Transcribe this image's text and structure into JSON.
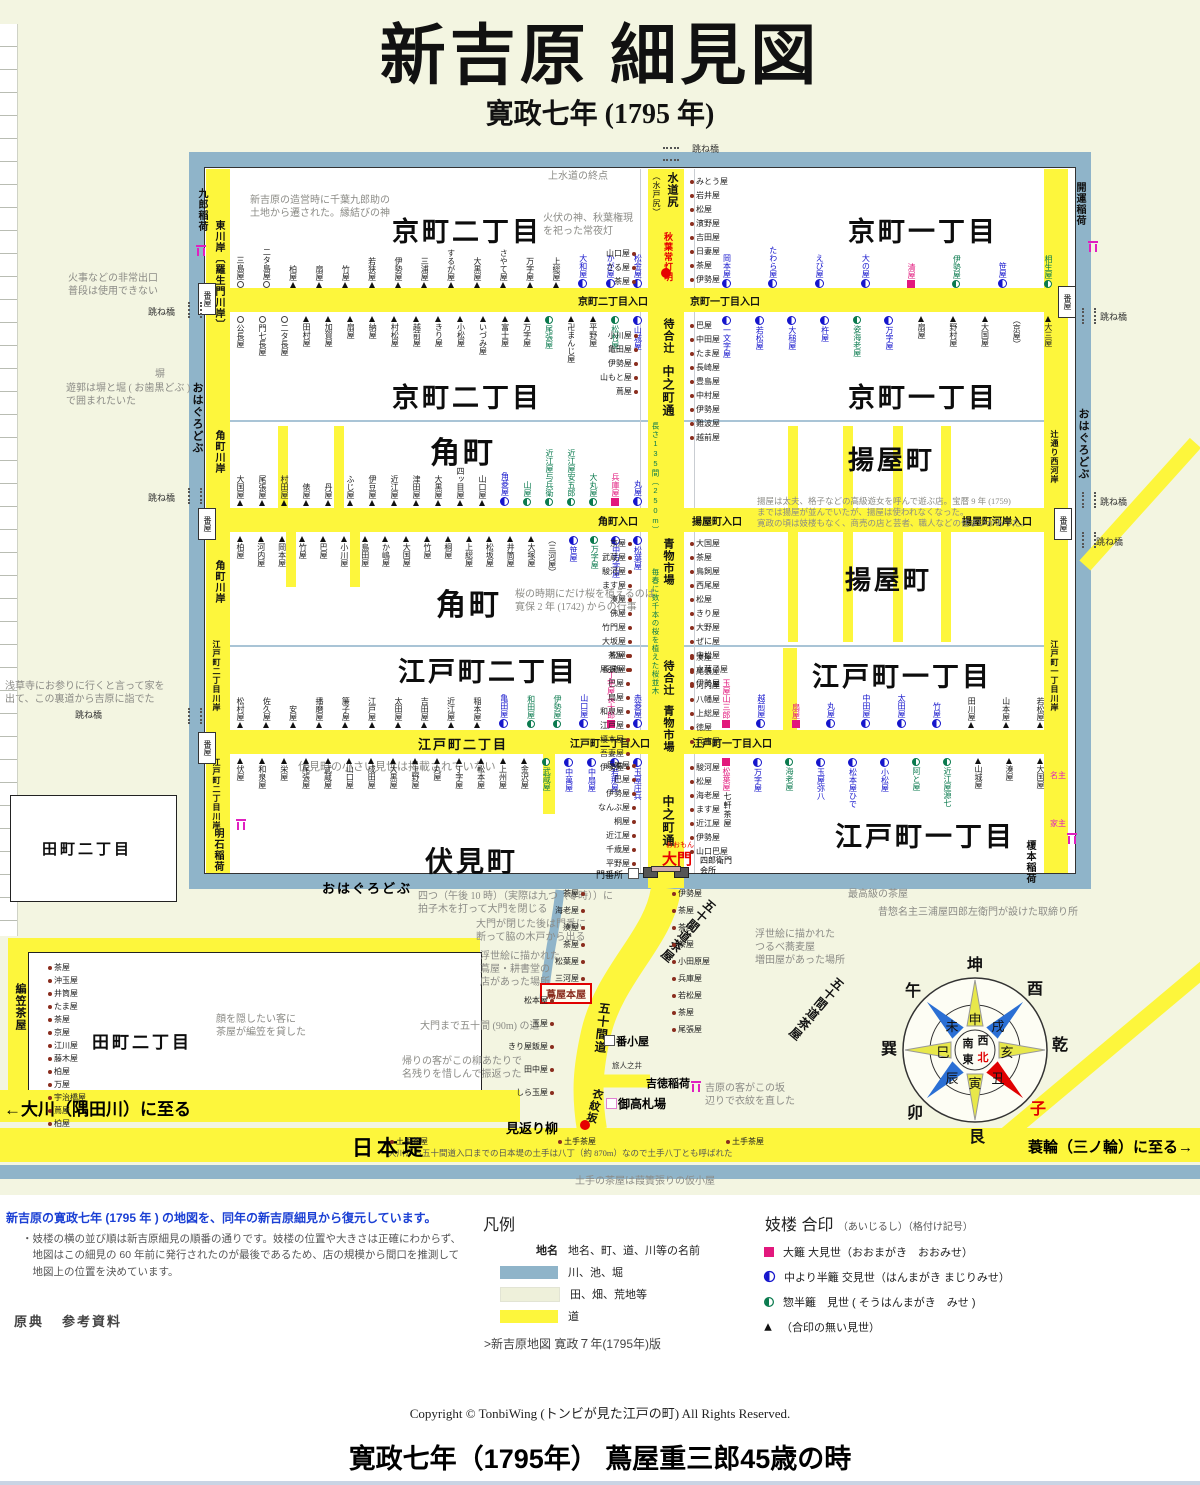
{
  "title": "新吉原 細見図",
  "subtitle": "寛政七年 (1795 年)",
  "map": {
    "districts": {
      "kyo2": "京町二丁目",
      "kyo1": "京町一丁目",
      "sumicho": "角町",
      "ageya": "揚屋町",
      "edo2": "江戸町二丁目",
      "edo1": "江戸町一丁目",
      "fushimi": "伏見町",
      "tamachi2": "田町二丁目"
    },
    "entrances": {
      "kyo2": "京町二丁目入口",
      "kyo1": "京町一丁目入口",
      "sumicho": "角町入口",
      "ageya": "揚屋町入口",
      "ageyakashi": "揚屋町河岸入口",
      "edo2": "江戸町二丁目入口",
      "edo1": "江戸町一丁目入口"
    },
    "streets": {
      "higashikawagishi": "東川岸〔羅生門川岸〕",
      "sumichokawagishi": "角町川岸",
      "edo2kawagishi": "江戸町二丁目川岸",
      "edo1kawagishi": "江戸町一丁目川岸",
      "tsujidori": "辻通り西河岸",
      "ohaguro": "おはぐろどぶ",
      "nakanocho": "中之町通",
      "machiaitsuji": "待合辻",
      "aomono": "青物市場",
      "nagasa": "長さ135間（250m）",
      "sakura": "毎春に数千本の桜を植えた桜並木",
      "mizudojiri": "水道尻",
      "mitojiri": "（水戸尻）",
      "gojikkendo": "五十間道",
      "gojikkenchaya": "五十間道茶屋",
      "emonzaka": "衣紋坂",
      "nihondutsumi": "日本堤",
      "okawa": "←大川（隅田川）に至る",
      "minowa": "蓑輪（三ノ輪）に至る→",
      "amigasa": "編笠茶屋",
      "edo2onroad": "江戸町二丁目"
    },
    "shrines": {
      "kuro": "九郎稲荷",
      "kaiun": "開運稲荷",
      "akashi": "明石稲荷",
      "enomoto": "榎本稲荷",
      "yoshitoku": "吉徳稲荷"
    },
    "features": {
      "akiba": "秋葉常灯明",
      "omon": "大門",
      "omonkana": "おおもん",
      "monbansho": "門番所",
      "kaisho": "四郎衛門会所",
      "shichiken": "七軒茶屋",
      "tsutaya": "蔦屋本屋",
      "mikaeri": "見返り柳",
      "kosatsuba": "御高札場",
      "bangoya": "番小屋",
      "tabibito": "旅人之井",
      "banya": "番屋",
      "hanebashi": "跳ね橋",
      "hei": "塀",
      "dotechaya": "土手茶屋",
      "nushi": "名主",
      "yanushi": "家主"
    },
    "annotations": {
      "a1": "新吉原の造営時に千葉九郎助の\n土地から遷された。縁結びの神",
      "a2": "火伏の神、秋葉権現\nを祀った常夜灯",
      "a3": "上水道の終点",
      "a4": "火事などの非常出口\n普段は使用できない",
      "a6": "遊郭は塀と堀 ( お歯黒どぶ )\nで囲まれたいた",
      "a7": "浅草寺にお参りに行くと言って家を\n出て、この裏道から吉原に詣でた",
      "a8": "揚屋は太夫、格子などの高級遊女を呼んで遊ぶ店。宝暦 9 年 (1759)\nまでは揚屋が並んでいたが、揚屋は使われなくなった。\n寛政の頃は妓楼もなく、商売の店と芸者、職人などの住まいがあった。",
      "a9": "桜の時期にだけ桜を植えるのは\n寛保 2 年 (1742) からの行事",
      "a10": "伏見町の小さい見世は掲載されていない",
      "a11": "四つ（午後 10 時）（実際は九つ（零時））に\n拍子木を打って大門を閉じる",
      "a12": "大門が閉じた後は門番に\n断って脇の木戸から出る",
      "a13": "浮世絵に描かれた\n蔦屋・耕書堂の\n店があった場所",
      "a14": "大門まで五十間 (90m) の道",
      "a15": "最高級の茶屋",
      "a16": "昔惣名主三浦屋四郎左衛門が設けた取締り所",
      "a17": "浮世絵に描かれた\nつるべ蕎麦屋\n増田屋があった場所",
      "a18": "吉原の客がこの坂\n辺りで衣紋を直した",
      "a19": "帰りの客がこの柳あたりで\n名残りを惜しんで振返った",
      "a20": "大川から五十間道入口までの日本堤の土手は八丁（約 870m）なので土手八丁とも呼ばれた",
      "a21": "土手の茶屋は葭簀張りの仮小屋",
      "a22": "顔を隠したい客に\n茶屋が編笠を貸した"
    },
    "rows": {
      "kyo2n": [
        {
          "n": "三島屋",
          "m": "o"
        },
        {
          "n": "二タ島屋",
          "m": "o"
        },
        {
          "n": "柏屋",
          "m": "t"
        },
        {
          "n": "扇屋",
          "m": "t"
        },
        {
          "n": "竹屋",
          "m": "t"
        },
        {
          "n": "若狭屋",
          "m": "t"
        },
        {
          "n": "伊勢屋",
          "m": "t"
        },
        {
          "n": "三浦屋",
          "m": "t"
        },
        {
          "n": "するが屋",
          "m": "t"
        },
        {
          "n": "大黒屋",
          "m": "t"
        },
        {
          "n": "さやて屋",
          "m": "t"
        },
        {
          "n": "万字屋",
          "m": "t"
        },
        {
          "n": "上総屋",
          "m": "t"
        },
        {
          "n": "大和屋",
          "m": "b"
        },
        {
          "n": "かが屋",
          "m": "b"
        },
        {
          "n": "松金屋",
          "m": "b"
        }
      ],
      "kyo2s": [
        {
          "n": "公長屋",
          "m": "o"
        },
        {
          "n": "門七長屋",
          "m": "o"
        },
        {
          "n": "二タ長屋",
          "m": "o"
        },
        {
          "n": "田村屋",
          "m": "t"
        },
        {
          "n": "加賀屋",
          "m": "t"
        },
        {
          "n": "扇屋",
          "m": "t"
        },
        {
          "n": "納屋",
          "m": "t"
        },
        {
          "n": "村松屋",
          "m": "t"
        },
        {
          "n": "越前屋",
          "m": "t"
        },
        {
          "n": "きり屋",
          "m": "t"
        },
        {
          "n": "小松屋",
          "m": "t"
        },
        {
          "n": "いづみ屋",
          "m": "t"
        },
        {
          "n": "富士屋",
          "m": "t"
        },
        {
          "n": "万字屋",
          "m": "t"
        },
        {
          "n": "尾張屋",
          "m": "g"
        },
        {
          "n": "卍まんじ屋",
          "m": "t"
        },
        {
          "n": "平野屋",
          "m": "t"
        },
        {
          "n": "松村屋",
          "m": "g"
        },
        {
          "n": "山城屋",
          "m": "b"
        }
      ],
      "kyo1n": [
        {
          "n": "岡本屋",
          "m": "b"
        },
        {
          "n": "たわら屋",
          "m": "b"
        },
        {
          "n": "えび屋",
          "m": "b"
        },
        {
          "n": "大の屋",
          "m": "b"
        },
        {
          "n": "清屋",
          "m": "m"
        },
        {
          "n": "伊勢屋",
          "m": "g"
        },
        {
          "n": "笹屋",
          "m": "b"
        },
        {
          "n": "相生屋",
          "m": "g"
        }
      ],
      "kyo1s": [
        {
          "n": "一文字屋",
          "m": "b"
        },
        {
          "n": "若松屋",
          "m": "b"
        },
        {
          "n": "大槌屋",
          "m": "b"
        },
        {
          "n": "杵屋",
          "m": "b"
        },
        {
          "n": "姿海老屋",
          "m": "g"
        },
        {
          "n": "万字屋",
          "m": "b"
        },
        {
          "n": "扇屋",
          "m": "t"
        },
        {
          "n": "野村屋",
          "m": "t"
        },
        {
          "n": "大国屋",
          "m": "t"
        },
        {
          "n": "（京屋）",
          "m": "none"
        },
        {
          "n": "大三屋",
          "m": "t"
        }
      ],
      "sumin": [
        {
          "n": "大国屋",
          "m": "t"
        },
        {
          "n": "尾張屋",
          "m": "t"
        },
        {
          "n": "村田屋",
          "m": "t"
        },
        {
          "n": "俵屋",
          "m": "t"
        },
        {
          "n": "丹屋",
          "m": "t"
        },
        {
          "n": "ふじ屋",
          "m": "t"
        },
        {
          "n": "伊豆屋",
          "m": "t"
        },
        {
          "n": "近江屋",
          "m": "t"
        },
        {
          "n": "津田屋",
          "m": "t"
        },
        {
          "n": "大黒屋",
          "m": "t"
        },
        {
          "n": "四ッ目屋",
          "m": "t"
        },
        {
          "n": "山口屋",
          "m": "t"
        },
        {
          "n": "角菱屋",
          "m": "b"
        },
        {
          "n": "山屋",
          "m": "g"
        },
        {
          "n": "近江屋与兵衛",
          "m": "g"
        },
        {
          "n": "近江屋安五郎",
          "m": "g"
        },
        {
          "n": "大丸屋",
          "m": "g"
        },
        {
          "n": "兵庫屋",
          "m": "m"
        },
        {
          "n": "丸屋",
          "m": "b"
        }
      ],
      "sumis": [
        {
          "n": "柏屋",
          "m": "t"
        },
        {
          "n": "河内屋",
          "m": "t"
        },
        {
          "n": "岡本屋",
          "m": "t"
        },
        {
          "n": "竹屋",
          "m": "t"
        },
        {
          "n": "巴屋",
          "m": "t"
        },
        {
          "n": "小川屋",
          "m": "t"
        },
        {
          "n": "島田屋",
          "m": "t"
        },
        {
          "n": "か嶋屋",
          "m": "t"
        },
        {
          "n": "大国屋",
          "m": "t"
        },
        {
          "n": "竹屋",
          "m": "t"
        },
        {
          "n": "桐屋",
          "m": "t"
        },
        {
          "n": "上総屋",
          "m": "t"
        },
        {
          "n": "松坂屋",
          "m": "t"
        },
        {
          "n": "井筒屋",
          "m": "t"
        },
        {
          "n": "大塚屋",
          "m": "t"
        },
        {
          "n": "（三河屋）",
          "m": "none"
        },
        {
          "n": "笹屋",
          "m": "b"
        },
        {
          "n": "万字屋",
          "m": "g"
        },
        {
          "n": "中万字屋",
          "m": "b"
        },
        {
          "n": "松葉屋",
          "m": "b"
        }
      ],
      "edo2n": [
        {
          "n": "松村屋",
          "m": "t"
        },
        {
          "n": "佐久屋",
          "m": "t"
        },
        {
          "n": "安屋",
          "m": "t"
        },
        {
          "n": "播磨屋",
          "m": "t"
        },
        {
          "n": "簾子屋",
          "m": "t"
        },
        {
          "n": "江戸屋",
          "m": "t"
        },
        {
          "n": "太田屋",
          "m": "t"
        },
        {
          "n": "吉田屋",
          "m": "t"
        },
        {
          "n": "近江屋",
          "m": "t"
        },
        {
          "n": "稲本屋",
          "m": "t"
        },
        {
          "n": "亀田屋",
          "m": "b"
        },
        {
          "n": "和田屋",
          "m": "g"
        },
        {
          "n": "伊勢屋",
          "m": "g"
        },
        {
          "n": "山口屋",
          "m": "b"
        },
        {
          "n": "丁字屋長十郎",
          "m": "m"
        },
        {
          "n": "赤菱屋",
          "m": "b"
        }
      ],
      "edo2s": [
        {
          "n": "伏屋",
          "m": "t"
        },
        {
          "n": "和泉屋",
          "m": "t"
        },
        {
          "n": "栄屋",
          "m": "t"
        },
        {
          "n": "尾張屋",
          "m": "t"
        },
        {
          "n": "武蔵屋",
          "m": "t"
        },
        {
          "n": "山口屋",
          "m": "t"
        },
        {
          "n": "成田屋",
          "m": "t"
        },
        {
          "n": "大黒屋",
          "m": "t"
        },
        {
          "n": "上野屋",
          "m": "t"
        },
        {
          "n": "丸屋",
          "m": "t"
        },
        {
          "n": "丁字屋",
          "m": "t"
        },
        {
          "n": "松本屋",
          "m": "t"
        },
        {
          "n": "上州屋",
          "m": "t"
        },
        {
          "n": "金沢屋",
          "m": "t"
        },
        {
          "n": "武蔵屋",
          "m": "g"
        },
        {
          "n": "中萬屋",
          "m": "b"
        },
        {
          "n": "中扇屋",
          "m": "b"
        },
        {
          "n": "若那屋",
          "m": "b"
        },
        {
          "n": "玉屋庄兵",
          "m": "b"
        }
      ],
      "edo1n": [
        {
          "n": "玉屋山三郎",
          "m": "m"
        },
        {
          "n": "越前屋",
          "m": "b"
        },
        {
          "n": "扇屋",
          "m": "m"
        },
        {
          "n": "丸屋",
          "m": "b"
        },
        {
          "n": "中田屋",
          "m": "b"
        },
        {
          "n": "太田屋",
          "m": "b"
        },
        {
          "n": "竹屋",
          "m": "b"
        },
        {
          "n": "田川屋",
          "m": "t"
        },
        {
          "n": "山本屋",
          "m": "t"
        },
        {
          "n": "若松屋",
          "m": "t"
        }
      ],
      "edo1s": [
        {
          "n": "松葉屋",
          "m": "m"
        },
        {
          "n": "万字屋",
          "m": "b"
        },
        {
          "n": "海老屋",
          "m": "g"
        },
        {
          "n": "玉屋弥八",
          "m": "b"
        },
        {
          "n": "松本屋ひで",
          "m": "b"
        },
        {
          "n": "小松屋",
          "m": "b"
        },
        {
          "n": "阿と屋",
          "m": "g"
        },
        {
          "n": "近江屋源七",
          "m": "g"
        },
        {
          "n": "山城屋",
          "m": "t"
        },
        {
          "n": "湊屋",
          "m": "t"
        },
        {
          "n": "大国屋",
          "m": "t"
        }
      ]
    },
    "cols": {
      "ne": [
        {
          "n": "みとう屋"
        },
        {
          "n": "岩井屋"
        },
        {
          "n": "松屋"
        },
        {
          "n": "濱野屋"
        },
        {
          "n": "吉田屋"
        },
        {
          "n": "日妻屋"
        },
        {
          "n": "茶屋"
        },
        {
          "n": "伊勢屋"
        }
      ],
      "nw": [
        {
          "n": "山口屋"
        },
        {
          "n": "さる屋"
        },
        {
          "n": "茶屋"
        }
      ],
      "me": [
        {
          "n": "巴屋"
        },
        {
          "n": "中田屋"
        },
        {
          "n": "たま屋"
        },
        {
          "n": "長崎屋"
        },
        {
          "n": "豊島屋"
        },
        {
          "n": "中村屋"
        },
        {
          "n": "伊勢屋"
        },
        {
          "n": "難波屋"
        },
        {
          "n": "越前屋"
        }
      ],
      "mw": [
        {
          "n": "小川屋"
        },
        {
          "n": "亀田屋"
        },
        {
          "n": "伊勢屋"
        },
        {
          "n": "山もと屋"
        },
        {
          "n": "蔦屋"
        }
      ],
      "se": [
        {
          "n": "大国屋"
        },
        {
          "n": "茶屋"
        },
        {
          "n": "鳥飼屋"
        },
        {
          "n": "西尾屋"
        },
        {
          "n": "松屋"
        },
        {
          "n": "きり屋"
        },
        {
          "n": "大野屋"
        },
        {
          "n": "ぜに屋"
        },
        {
          "n": "中松屋"
        },
        {
          "n": "水菓子屋"
        },
        {
          "n": "伊勢屋"
        }
      ],
      "sw": [
        {
          "n": "京屋"
        },
        {
          "n": "武蔵屋"
        },
        {
          "n": "駿河屋"
        },
        {
          "n": "ます屋"
        },
        {
          "n": "湊屋"
        },
        {
          "n": "佛屋"
        },
        {
          "n": "竹門屋"
        },
        {
          "n": "大坂屋"
        },
        {
          "n": "松屋"
        },
        {
          "n": "長崎屋"
        }
      ],
      "ee": [
        {
          "n": "湊屋"
        },
        {
          "n": "尾張屋"
        },
        {
          "n": "河内屋"
        },
        {
          "n": "八幡屋"
        },
        {
          "n": "上総屋"
        },
        {
          "n": "徳屋"
        },
        {
          "n": "兵庫屋"
        }
      ],
      "ew": [
        {
          "n": "茶屋"
        },
        {
          "n": "尾張屋"
        },
        {
          "n": "巴屋"
        },
        {
          "n": "扇屋"
        },
        {
          "n": "和泉屋"
        },
        {
          "n": "江戸屋"
        },
        {
          "n": "榎本屋"
        },
        {
          "n": "吾妻屋"
        },
        {
          "n": "伊勢屋"
        }
      ],
      "ge": [
        {
          "n": "駿河屋"
        },
        {
          "n": "松屋"
        },
        {
          "n": "海老屋"
        },
        {
          "n": "ます屋"
        },
        {
          "n": "近江屋"
        },
        {
          "n": "伊勢屋"
        },
        {
          "n": "山口巴屋"
        }
      ],
      "gw": [
        {
          "n": "兵庫屋"
        },
        {
          "n": "巴屋"
        },
        {
          "n": "伊勢屋"
        },
        {
          "n": "なんぶ屋"
        },
        {
          "n": "桐屋"
        },
        {
          "n": "近江屋"
        },
        {
          "n": "千歳屋"
        },
        {
          "n": "平野屋"
        }
      ],
      "fdl": [
        {
          "n": "松本屋"
        },
        {
          "n": "玉屋"
        },
        {
          "n": "きり屋飯屋"
        },
        {
          "n": "田中屋"
        },
        {
          "n": "しら玉屋"
        }
      ],
      "fdr": [
        {
          "n": "伊勢屋"
        },
        {
          "n": "茶屋"
        },
        {
          "n": "茶屋"
        },
        {
          "n": "茶屋"
        },
        {
          "n": "小田原屋"
        },
        {
          "n": "兵庫屋"
        },
        {
          "n": "若松屋"
        },
        {
          "n": "茶屋"
        },
        {
          "n": "尾張屋"
        }
      ],
      "fdi": [
        {
          "n": "茶屋"
        },
        {
          "n": "海老屋"
        },
        {
          "n": "湊屋"
        },
        {
          "n": "茶屋"
        },
        {
          "n": "松葉屋"
        },
        {
          "n": "三河屋"
        }
      ],
      "tam": [
        {
          "n": "茶屋"
        },
        {
          "n": "沖玉屋"
        },
        {
          "n": "井筒屋"
        },
        {
          "n": "たま屋"
        },
        {
          "n": "茶屋"
        },
        {
          "n": "京屋"
        },
        {
          "n": "江川屋"
        },
        {
          "n": "藤木屋"
        },
        {
          "n": "柏屋"
        },
        {
          "n": "万屋"
        },
        {
          "n": "宇治橋屋"
        },
        {
          "n": "蔦屋"
        },
        {
          "n": "柏屋"
        }
      ],
      "dote": [
        {
          "n": "土手茶屋"
        },
        {
          "n": "土手茶屋"
        },
        {
          "n": "土手茶屋"
        }
      ]
    }
  },
  "compass": {
    "outer": [
      "坤",
      "酉",
      "乾",
      "子",
      "艮",
      "卯",
      "巽",
      "午"
    ],
    "ring": [
      "申",
      "戌",
      "亥",
      "丑",
      "寅",
      "辰",
      "巳",
      "未"
    ],
    "center": [
      "南",
      "西",
      "東",
      "北"
    ]
  },
  "legend": {
    "hanrei_title": "凡例",
    "chimei_label": "地名",
    "chimei_desc": "地名、町、道、川等の名前",
    "area_rows": [
      {
        "sw": "water",
        "label": "川、池、堀"
      },
      {
        "sw": "field",
        "label": "田、畑、荒地等"
      },
      {
        "sw": "road",
        "label": "道"
      }
    ],
    "map_link": ">新吉原地図 寛政７年(1795年)版",
    "giro_title": "妓楼 合印",
    "giro_sub": "（あいじるし）（格付け記号）",
    "giro_rows": [
      {
        "m": "m",
        "label": "大籬 大見世（おおまがき　おおみせ）"
      },
      {
        "m": "b",
        "label": "中より半籬 交見世（はんまがき まじりみせ）"
      },
      {
        "m": "g",
        "label": "惣半籬　見世 ( そうはんまがき　みせ )"
      },
      {
        "m": "t",
        "label": "（合印の無い見世）"
      }
    ],
    "intro": "新吉原の寛政七年 (1795 年 ) の地図を、同年の新吉原細見から復元しています。",
    "note": "・妓楼の横の並び順は新吉原細見の順番の通りです。妓楼の位置や大きさは正確にわからず、\n　地図はこの細見の 60 年前に発行されたのが最後であるため、店の規模から間口を推測して\n　地図上の位置を決めています。",
    "gensho": "原典",
    "sanko": "参考資料"
  },
  "footer": {
    "copyright": "Copyright © TonbiWing (トンビが見た江戸の町) All Rights Reserved.",
    "caption": "寛政七年（1795年） 蔦屋重三郎45歳の時"
  }
}
